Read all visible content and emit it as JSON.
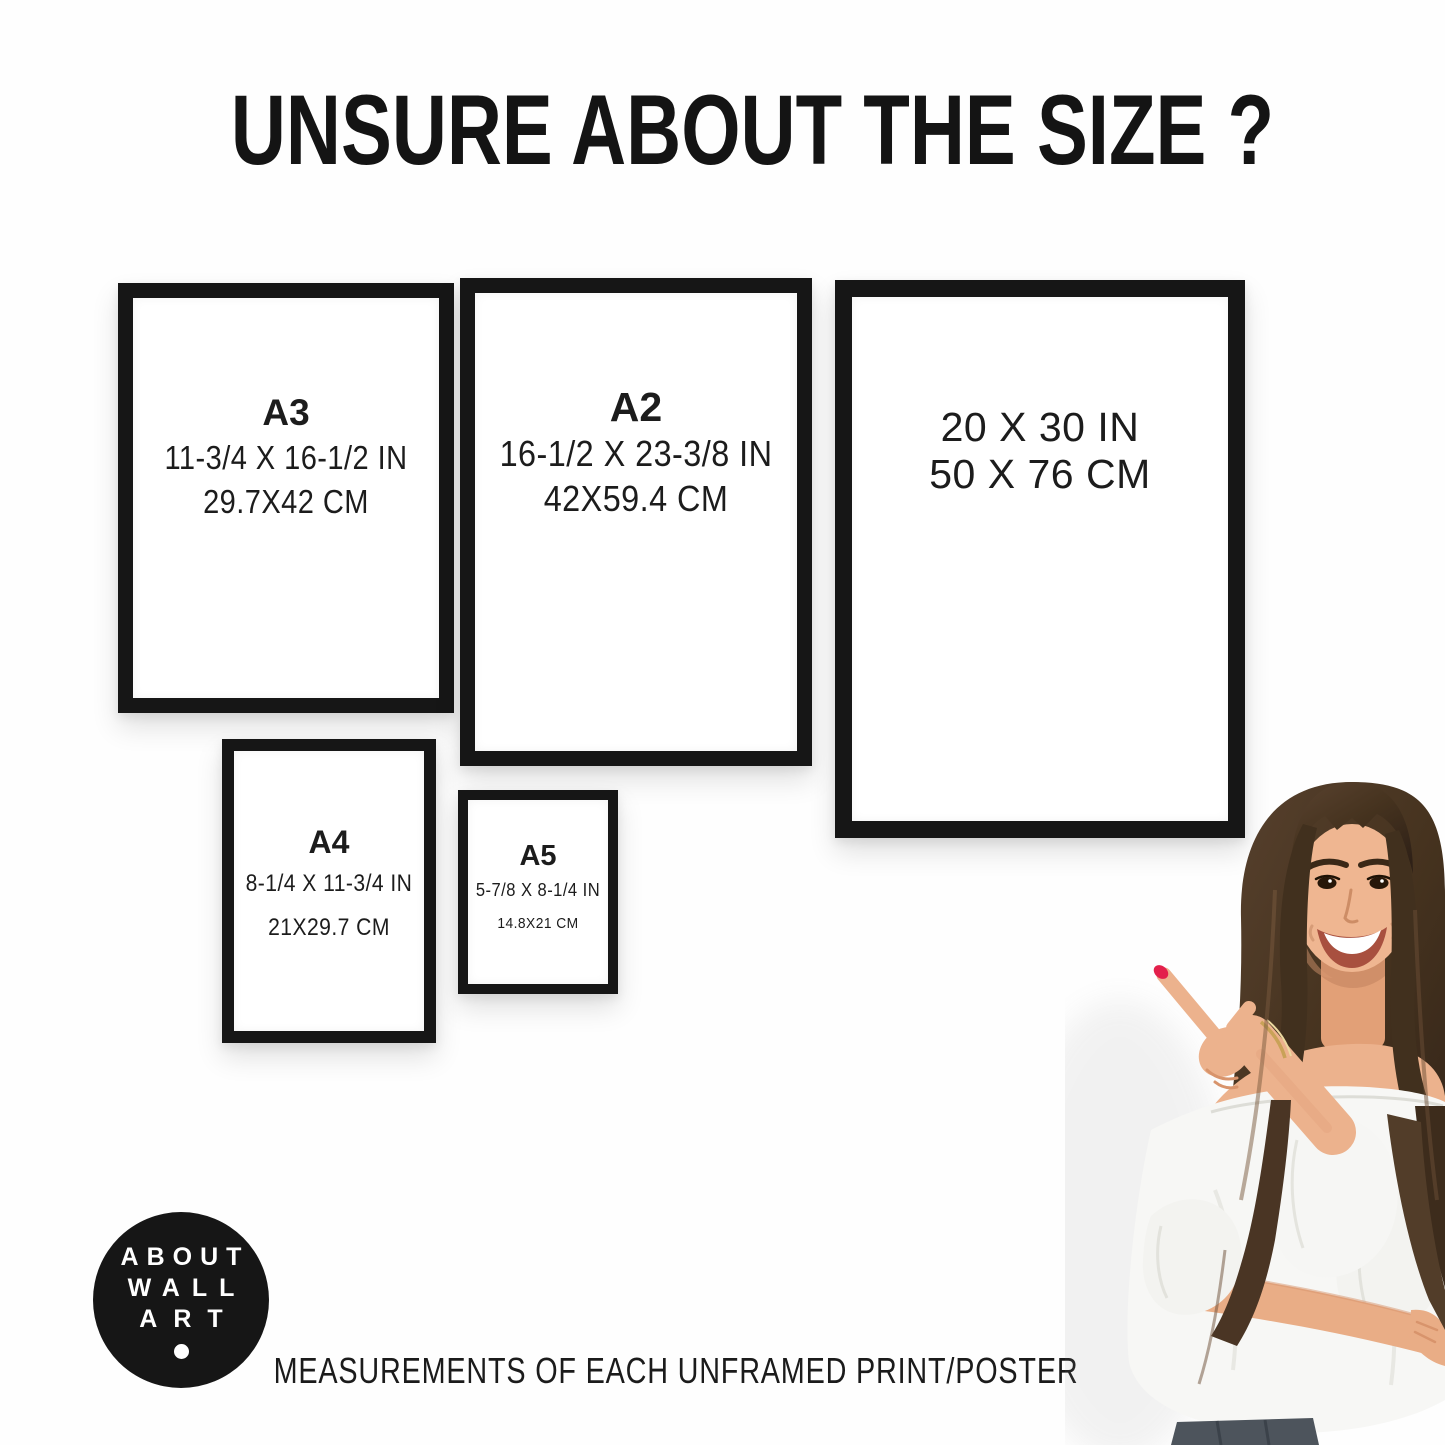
{
  "title": "UNSURE ABOUT THE SIZE ?",
  "footer": "MEASUREMENTS OF EACH UNFRAMED PRINT/POSTER",
  "logo": {
    "line1": "ABOUT",
    "line2": "WALL",
    "line3": "ART"
  },
  "frames": {
    "a3": {
      "label": "A3",
      "inches": "11-3/4 X 16-1/2 IN",
      "cm": "29.7X42 CM"
    },
    "a2": {
      "label": "A2",
      "inches": "16-1/2 X 23-3/8 IN",
      "cm": "42X59.4 CM"
    },
    "p2030": {
      "inches": "20 X 30 IN",
      "cm": "50 X 76 CM"
    },
    "a4": {
      "label": "A4",
      "inches": "8-1/4 X 11-3/4 IN",
      "cm": "21X29.7 CM"
    },
    "a5": {
      "label": "A5",
      "inches": "5-7/8 X 8-1/4 IN",
      "cm": "14.8X21 CM"
    }
  },
  "colors": {
    "background": "#ffffff",
    "frame_border": "#161616",
    "text": "#1a1a1a",
    "logo_bg": "#161616",
    "logo_text": "#ffffff",
    "nail_polish": "#e3204b",
    "hair": "#46331f",
    "skin": "#ecb28d",
    "blouse": "#f6f6f4",
    "jeans": "#4d545c"
  }
}
